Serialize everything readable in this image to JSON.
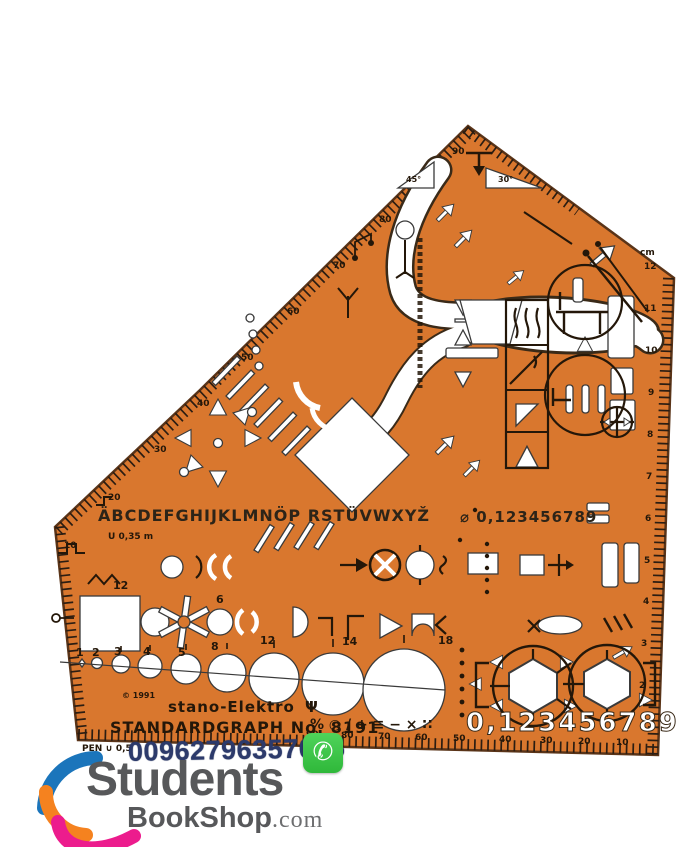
{
  "product": {
    "apex_label": "90",
    "angle_left": "45°",
    "angle_right": "30°",
    "unit": "cm",
    "alphabet": "ÄBCDEFGHIJKLMNÖP RSTÜVWXYŽ",
    "line_gauge": "U 0,35 m",
    "digits_small": "⌀ 0,123456789",
    "digits_large": "0,123456789",
    "symbol_row": "% ○ / + ≡ − × ∷",
    "copyright": "© 1991",
    "brand": "stano-Elektro",
    "brand_mark": "Ψ",
    "model": "STANDARDGRAPH No. 8191",
    "pen": "PEN ∪ 0,5"
  },
  "rulers": {
    "left": [
      "80",
      "70",
      "60",
      "50",
      "40",
      "30",
      "20",
      "10"
    ],
    "bottom": [
      "90",
      "80",
      "70",
      "60",
      "50",
      "40",
      "30",
      "20",
      "10"
    ],
    "right": [
      "12",
      "11",
      "10",
      "9",
      "8",
      "7",
      "6",
      "5",
      "4",
      "3",
      "2"
    ]
  },
  "labels": {
    "square": "12",
    "circle_top": "6",
    "circles": [
      "1",
      "2",
      "3",
      "4",
      "5",
      "8",
      "12",
      "14",
      "18"
    ]
  },
  "overlay": {
    "phone": "00962796357075",
    "whatsapp_glyph": "✆",
    "logo_top": "Students",
    "logo_bottom": "BookShop",
    "logo_tld": ".com"
  },
  "colors": {
    "template_orange": "#d9772e",
    "print_dark": "#2b1d12",
    "cutout_white": "#ffffff",
    "whatsapp_green": "#35c23f",
    "phone_text": "#2c3a6b",
    "logo_gray": "#57585a",
    "logo_blue": "#1b75bb",
    "logo_orange": "#f5821f",
    "logo_pink": "#ec1c8d"
  }
}
